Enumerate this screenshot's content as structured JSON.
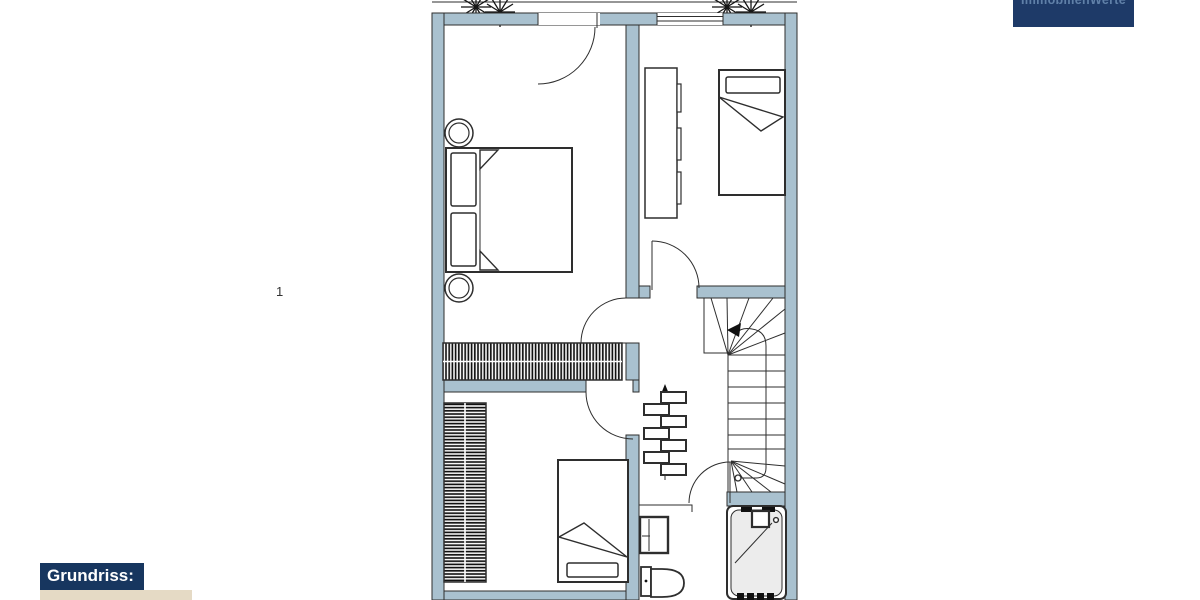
{
  "logo": {
    "text": "ImmobilienWerte"
  },
  "marker": {
    "text": "1"
  },
  "caption": {
    "label": "Grundriss:"
  },
  "colors": {
    "wall": "#a9c1cf",
    "line": "#2e2e2e",
    "hatch": "#111111",
    "tub": "#ececec",
    "logo-bg": "#1e3a68",
    "logo-fg": "#6080a8",
    "cap-bg": "#17365f",
    "cap-fg": "#ffffff",
    "accent": "#e5dac5",
    "marker": "#333333"
  },
  "floorplan": {
    "symbols": [
      "balcony-tree",
      "balcony-door",
      "window",
      "double-bed",
      "nightstand",
      "wardrobe-hatched",
      "shelf",
      "single-bed",
      "winder-staircase",
      "walk-line-arrow",
      "radiator",
      "washbasin",
      "toilet",
      "bathtub",
      "door-swing"
    ]
  }
}
